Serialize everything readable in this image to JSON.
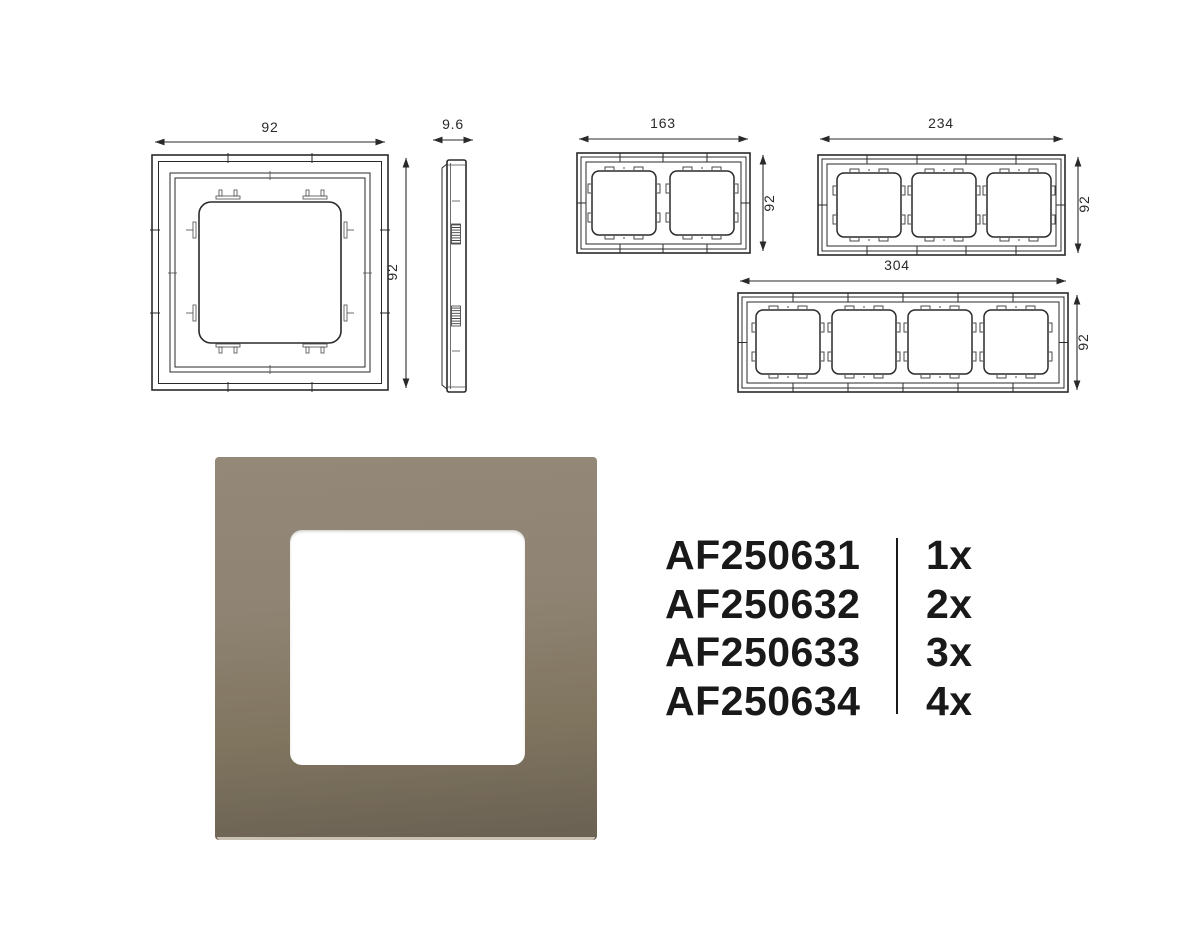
{
  "drawings": {
    "single": {
      "width_label": "92",
      "height_label": "92"
    },
    "side": {
      "depth_label": "9.6"
    },
    "gang2": {
      "width_label": "163",
      "height_label": "92"
    },
    "gang3": {
      "width_label": "234",
      "height_label": "92"
    },
    "gang4": {
      "width_label": "304",
      "height_label": "92"
    }
  },
  "product": {
    "frame_color_top": "#948878",
    "frame_color_bottom": "#6c6254",
    "opening_color": "#ffffff"
  },
  "parts": {
    "items": [
      {
        "sku": "AF250631",
        "qty": "1x"
      },
      {
        "sku": "AF250632",
        "qty": "2x"
      },
      {
        "sku": "AF250633",
        "qty": "3x"
      },
      {
        "sku": "AF250634",
        "qty": "4x"
      }
    ]
  }
}
